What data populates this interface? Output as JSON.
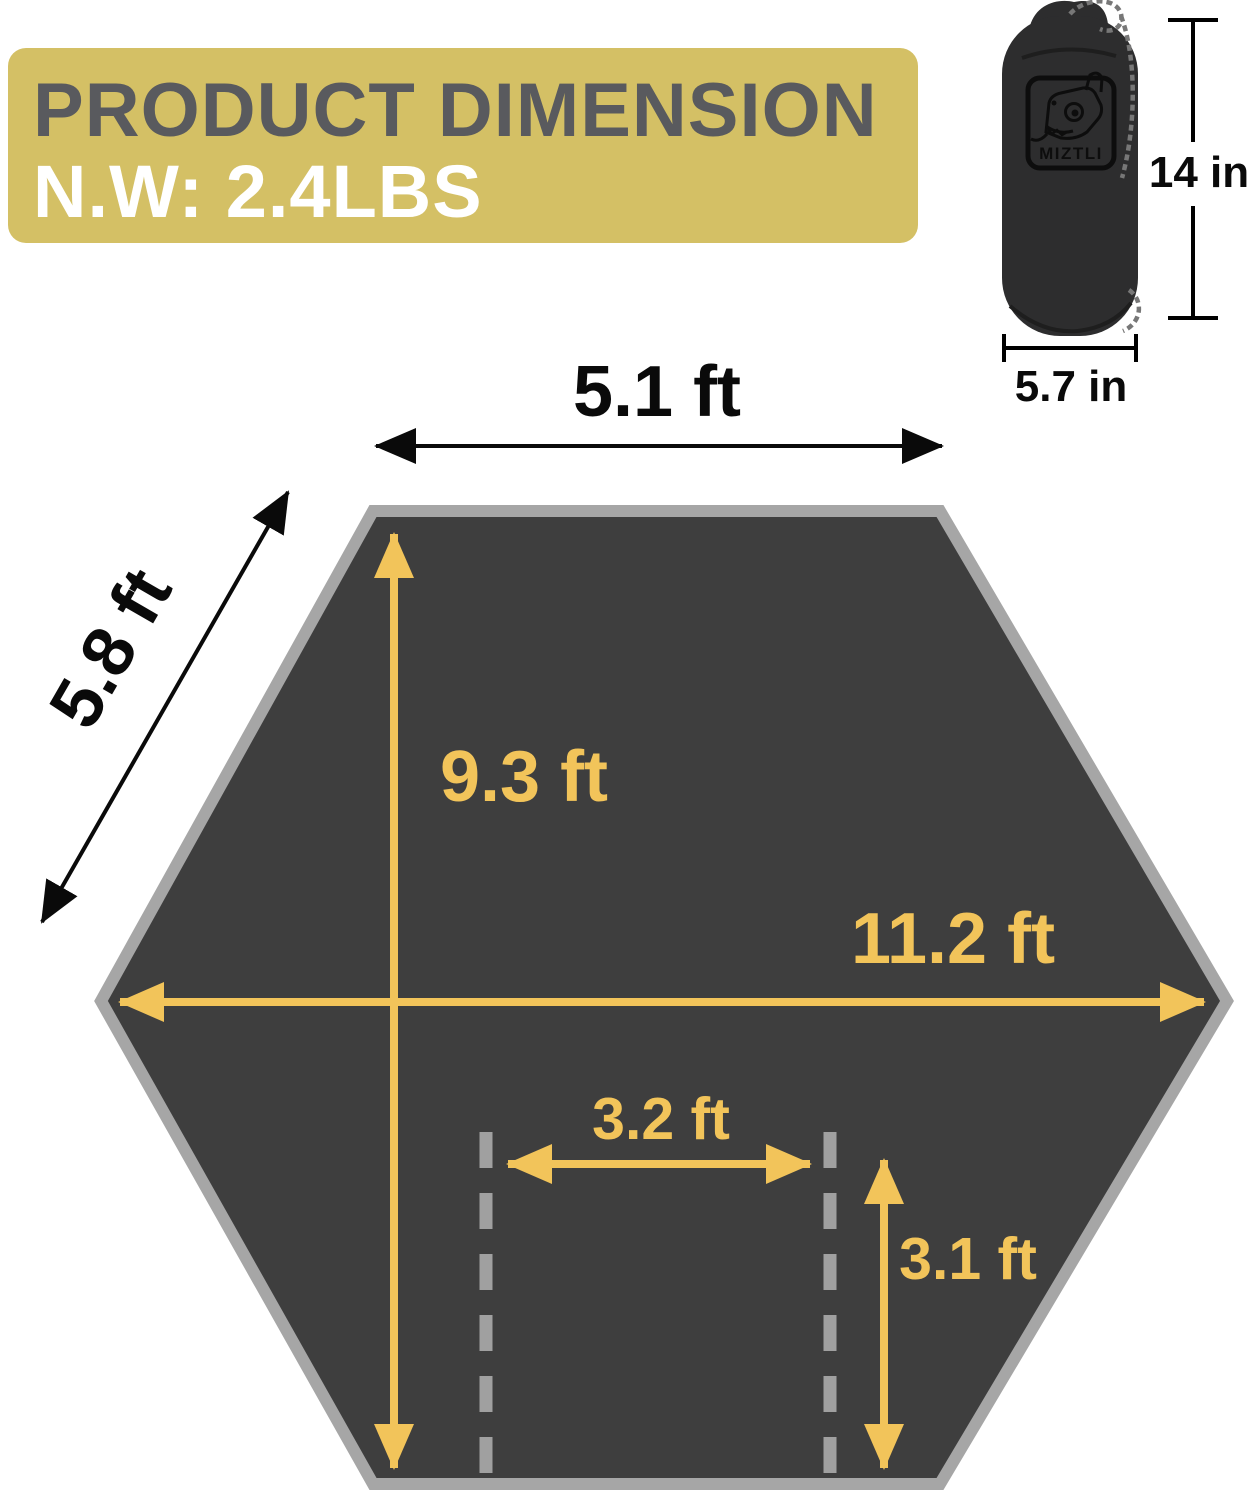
{
  "banner": {
    "title": "PRODUCT DIMENSION",
    "net_weight": "N.W: 2.4LBS"
  },
  "stuff_sack": {
    "brand": "MIZTLI",
    "height_label": "14 in",
    "width_label": "5.7 in"
  },
  "tarp": {
    "top_edge_label": "5.1 ft",
    "side_edge_label": "5.8 ft",
    "center_height_label": "9.3 ft",
    "max_width_label": "11.2 ft",
    "inner_width_label": "3.2 ft",
    "inner_height_label": "3.1 ft"
  },
  "colors": {
    "banner_bg": "#d4c065",
    "banner_title_text": "#595a5e",
    "banner_weight_text": "#ffffff",
    "tarp_fill": "#3e3e3e",
    "tarp_border": "#a6a6a6",
    "accent_yellow": "#f2c45a",
    "dashed_line_gray": "#a0a0a0",
    "dimension_black": "#000000",
    "sack_fill": "#2d2d2e"
  }
}
